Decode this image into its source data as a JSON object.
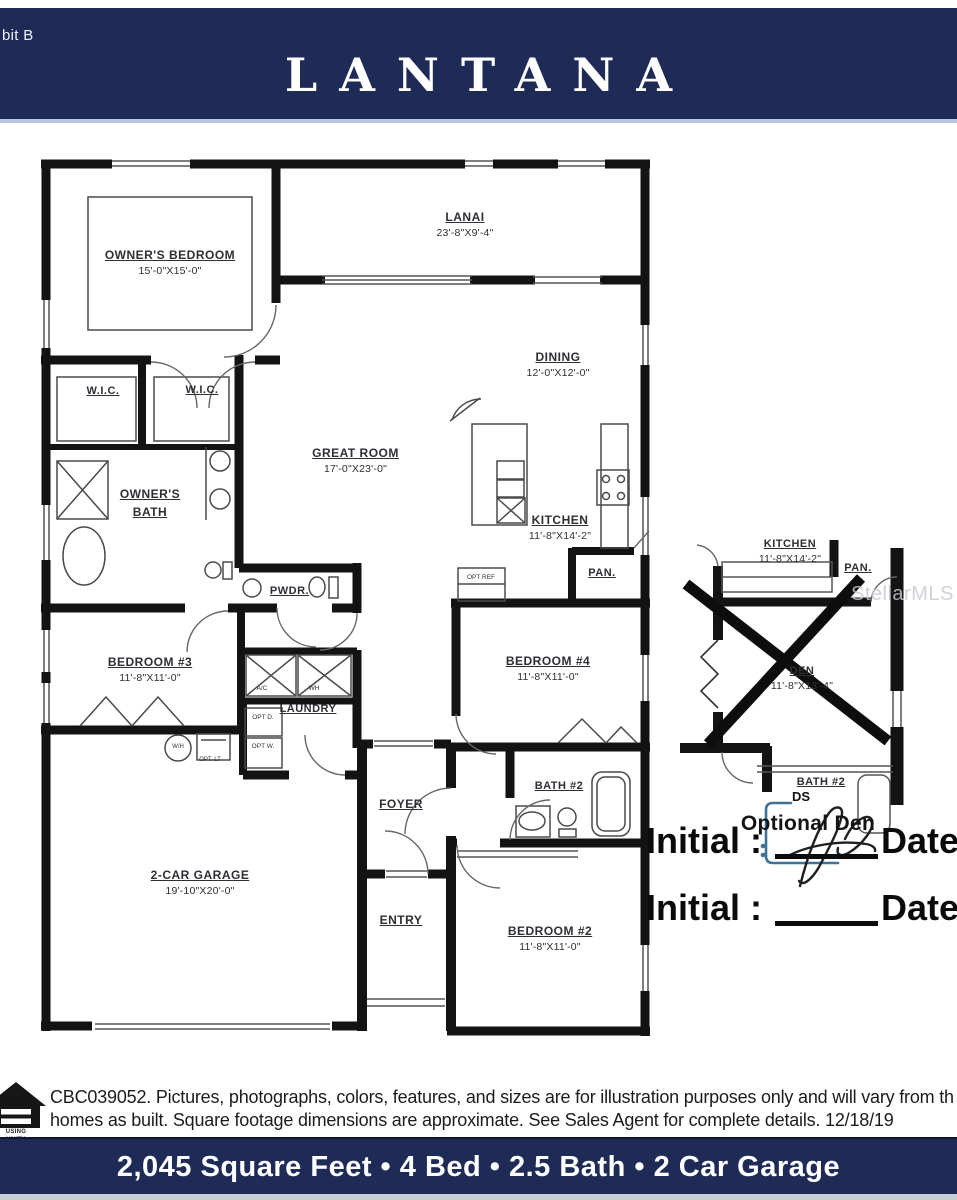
{
  "header": {
    "exhibit_partial": "bit B",
    "title": "LANTANA"
  },
  "watermark": {
    "text": "StellarMLS"
  },
  "plan": {
    "rooms": {
      "owners_bedroom": {
        "name": "OWNER'S BEDROOM",
        "dims": "15'-0\"X15'-0\""
      },
      "lanai": {
        "name": "LANAI",
        "dims": "23'-8\"X9'-4\""
      },
      "dining": {
        "name": "DINING",
        "dims": "12'-0\"X12'-0\""
      },
      "great_room": {
        "name": "GREAT ROOM",
        "dims": "17'-0\"X23'-0\""
      },
      "kitchen": {
        "name": "KITCHEN",
        "dims": "11'-8\"X14'-2\""
      },
      "wic_left": {
        "name": "W.I.C."
      },
      "wic_right": {
        "name": "W.I.C."
      },
      "owners_bath": {
        "name": "OWNER'S BATH"
      },
      "powder": {
        "name": "PWDR."
      },
      "bedroom3": {
        "name": "BEDROOM #3",
        "dims": "11'-8\"X11'-0\""
      },
      "laundry": {
        "name": "LAUNDRY"
      },
      "pantry": {
        "name": "PAN."
      },
      "bedroom4": {
        "name": "BEDROOM #4",
        "dims": "11'-8\"X11'-0\""
      },
      "foyer": {
        "name": "FOYER"
      },
      "entry": {
        "name": "ENTRY"
      },
      "garage": {
        "name": "2-CAR GARAGE",
        "dims": "19'-10\"X20'-0\""
      },
      "bath2": {
        "name": "BATH #2"
      },
      "bedroom2": {
        "name": "BEDROOM #2",
        "dims": "11'-8\"X11'-0\""
      }
    },
    "equipment": {
      "opt_ref": "OPT REF",
      "ac": "A/C",
      "wh": "WH",
      "water_heater": "W/H",
      "opt_lt": "OPT. LT",
      "opt_d": "OPT D.",
      "opt_w": "OPT W."
    }
  },
  "inset": {
    "kitchen": {
      "name": "KITCHEN",
      "dims": "11'-8\"X14'-2\""
    },
    "pantry": {
      "name": "PAN."
    },
    "den": {
      "name": "DEN",
      "dims": "11'-8\"X13'-4\""
    },
    "bath2": {
      "name": "BATH #2"
    },
    "caption": "Optional Den",
    "docusign_tag": "DS"
  },
  "signature_block": {
    "rows": [
      {
        "initial_label": "Initial : ",
        "date_label": "Date"
      },
      {
        "initial_label": "Initial : ",
        "date_label": "Date"
      }
    ]
  },
  "disclaimer": {
    "line1": "CBC039052. Pictures, photographs, colors, features, and sizes are for illustration purposes only and will vary from th",
    "line2": "homes as built. Square footage dimensions are approximate.  See Sales Agent for complete details. 12/18/19"
  },
  "footer": {
    "summary": "2,045 Square Feet • 4 Bed • 2.5 Bath • 2 Car Garage"
  },
  "equal_housing": {
    "partial_line1": "USING",
    "partial_line2": "UNITY"
  },
  "colors": {
    "banner_navy": "#1f2b57",
    "accent_light_blue": "#b7c6e2",
    "signature_blue": "#3e7296",
    "watermark_gray": "#c6c9cf",
    "wall_black": "#131313"
  }
}
